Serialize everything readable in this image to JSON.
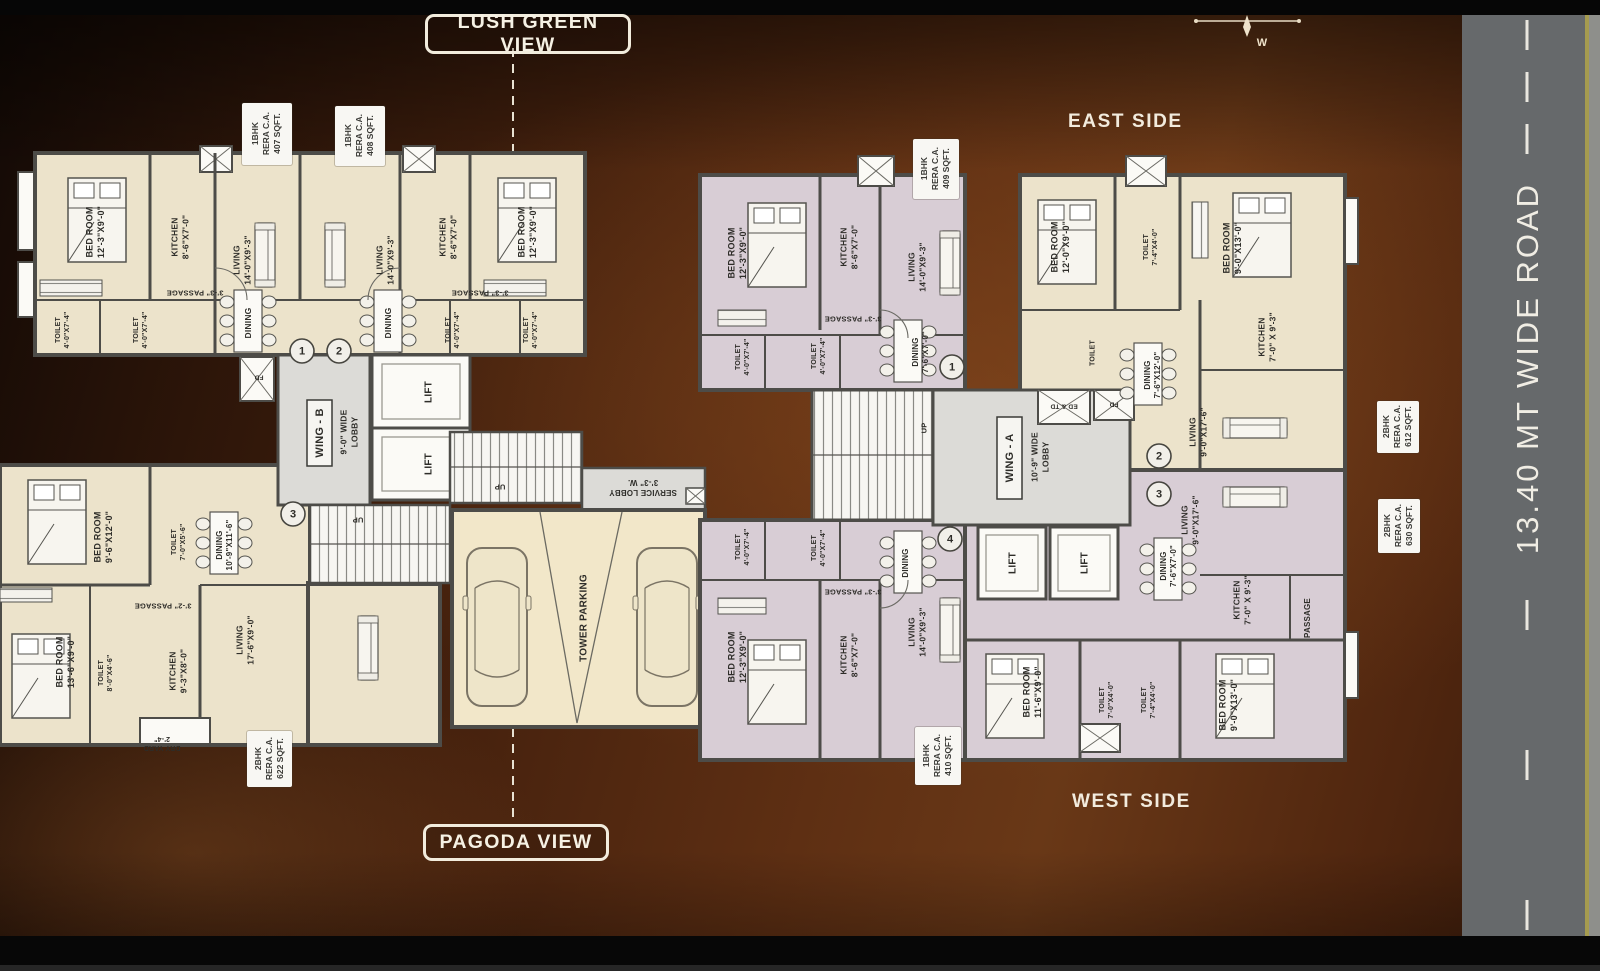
{
  "labels": {
    "lush_green_view": "LUSH GREEN VIEW",
    "pagoda_view": "PAGODA VIEW",
    "east_side": "EAST SIDE",
    "west_side": "WEST SIDE",
    "road": "13.40 MT WIDE ROAD",
    "compass_w": "W"
  },
  "colors": {
    "room_cream": "#ece3cb",
    "room_lavender": "#d8cdd5",
    "wall": "#4d4c48",
    "lobby_gray": "#dcdbd7",
    "road_gray": "#66696b",
    "road_edge_yellow": "#a59b4f",
    "background_brown": "#5e2f13"
  },
  "rera_labels": [
    {
      "unit": "1BHK",
      "cert": "RERA C.A.",
      "area": "407 SQFT.",
      "x": 242,
      "y": 103,
      "w": 50,
      "h": 62
    },
    {
      "unit": "1BHK",
      "cert": "RERA C.A.",
      "area": "408 SQFT.",
      "x": 335,
      "y": 106,
      "w": 50,
      "h": 60
    },
    {
      "unit": "1BHK",
      "cert": "RERA C.A.",
      "area": "409 SQFT.",
      "x": 913,
      "y": 139,
      "w": 46,
      "h": 60
    },
    {
      "unit": "1BHK",
      "cert": "RERA C.A.",
      "area": "410 SQFT.",
      "x": 915,
      "y": 727,
      "w": 46,
      "h": 58
    },
    {
      "unit": "2BHK",
      "cert": "RERA C.A.",
      "area": "612 SQFT.",
      "x": 1377,
      "y": 401,
      "w": 42,
      "h": 52
    },
    {
      "unit": "2BHK",
      "cert": "RERA C.A.",
      "area": "630 SQFT.",
      "x": 1378,
      "y": 499,
      "w": 42,
      "h": 54
    },
    {
      "unit": "2BHK",
      "cert": "RERA C.A.",
      "area": "622 SQFT.",
      "x": 247,
      "y": 731,
      "w": 45,
      "h": 56
    }
  ],
  "plan": {
    "wing_b_name": "WING - B",
    "wing_a_name": "WING - A",
    "entrance_numbers": [
      {
        "n": "1",
        "x": 302,
        "y": 351
      },
      {
        "n": "2",
        "x": 339,
        "y": 351
      },
      {
        "n": "3",
        "x": 293,
        "y": 514
      },
      {
        "n": "1",
        "x": 952,
        "y": 367
      },
      {
        "n": "2",
        "x": 1159,
        "y": 456
      },
      {
        "n": "3",
        "x": 1159,
        "y": 494
      },
      {
        "n": "4",
        "x": 950,
        "y": 539
      }
    ],
    "room_labels": [
      {
        "t": [
          "BED ROOM",
          "12'-3\"X9'-0\""
        ],
        "x": 95,
        "y": 232,
        "r": -90,
        "s": 9,
        "n": "room-label-bedroom"
      },
      {
        "t": [
          "KITCHEN",
          "8'-6\"X7'-0\""
        ],
        "x": 180,
        "y": 237,
        "r": -90,
        "s": 8.5,
        "n": "room-label-kitchen"
      },
      {
        "t": [
          "LIVING",
          "14'-0\"X9'-3\""
        ],
        "x": 242,
        "y": 260,
        "r": -90,
        "s": 8.5,
        "n": "room-label-living"
      },
      {
        "t": [
          "LIVING",
          "14'-0\"X9'-3\""
        ],
        "x": 385,
        "y": 260,
        "r": -90,
        "s": 8.5,
        "n": "room-label-living"
      },
      {
        "t": [
          "KITCHEN",
          "8'-6\"X7'-0\""
        ],
        "x": 448,
        "y": 237,
        "r": -90,
        "s": 8.5,
        "n": "room-label-kitchen"
      },
      {
        "t": [
          "BED ROOM",
          "12'-3\"X9'-0\""
        ],
        "x": 527,
        "y": 232,
        "r": -90,
        "s": 9,
        "n": "room-label-bedroom"
      },
      {
        "t": [
          "DINING"
        ],
        "x": 248,
        "y": 323,
        "r": -90,
        "s": 8.5,
        "n": "room-label-dining"
      },
      {
        "t": [
          "DINING"
        ],
        "x": 388,
        "y": 323,
        "r": -90,
        "s": 8.5,
        "n": "room-label-dining"
      },
      {
        "t": [
          "3'-3\" PASSAGE"
        ],
        "x": 195,
        "y": 293,
        "r": 180,
        "s": 7.5,
        "n": "room-label-passage"
      },
      {
        "t": [
          "3'-3\" PASSAGE"
        ],
        "x": 480,
        "y": 293,
        "r": 180,
        "s": 7.5,
        "n": "room-label-passage"
      },
      {
        "t": [
          "TOILET",
          "4'-0\"X7'-4\""
        ],
        "x": 62,
        "y": 330,
        "r": -90,
        "s": 7,
        "n": "room-label-toilet"
      },
      {
        "t": [
          "TOILET",
          "4'-0\"X7'-4\""
        ],
        "x": 140,
        "y": 330,
        "r": -90,
        "s": 7,
        "n": "room-label-toilet"
      },
      {
        "t": [
          "TOILET",
          "4'-0\"X7'-4\""
        ],
        "x": 452,
        "y": 330,
        "r": -90,
        "s": 7,
        "n": "room-label-toilet"
      },
      {
        "t": [
          "TOILET",
          "4'-0\"X7'-4\""
        ],
        "x": 530,
        "y": 330,
        "r": -90,
        "s": 7,
        "n": "room-label-toilet"
      },
      {
        "t": [
          "WING - B"
        ],
        "x": 319,
        "y": 433,
        "r": -90,
        "s": 11,
        "b": 1,
        "n": "wing-b-label"
      },
      {
        "t": [
          "9'-0\" WIDE",
          "LOBBY"
        ],
        "x": 349,
        "y": 432,
        "r": -90,
        "s": 8.5,
        "n": "lobby-label"
      },
      {
        "t": [
          "LIFT"
        ],
        "x": 428,
        "y": 392,
        "r": -90,
        "s": 10,
        "n": "lift-label"
      },
      {
        "t": [
          "LIFT"
        ],
        "x": 428,
        "y": 464,
        "r": -90,
        "s": 10,
        "n": "lift-label"
      },
      {
        "t": [
          "FD"
        ],
        "x": 259,
        "y": 378,
        "r": 180,
        "s": 6.5,
        "n": "duct-label"
      },
      {
        "t": [
          "UP"
        ],
        "x": 358,
        "y": 520,
        "r": 180,
        "s": 7.5,
        "n": "stairs-up-label"
      },
      {
        "t": [
          "UP"
        ],
        "x": 500,
        "y": 487,
        "r": 180,
        "s": 7.5,
        "n": "stairs-up-label"
      },
      {
        "t": [
          "SERVICE LOBBY",
          "3'-3\" W."
        ],
        "x": 643,
        "y": 488,
        "r": 180,
        "s": 8,
        "n": "service-lobby-label"
      },
      {
        "t": [
          "TOWER PARKING"
        ],
        "x": 583,
        "y": 618,
        "r": -90,
        "s": 10,
        "n": "parking-label"
      },
      {
        "t": [
          "BED ROOM",
          "9'-6\"X12'-0\""
        ],
        "x": 103,
        "y": 537,
        "r": -90,
        "s": 9,
        "n": "room-label-bedroom"
      },
      {
        "t": [
          "TOILET",
          "7'-0\"X5'-6\""
        ],
        "x": 178,
        "y": 542,
        "r": -90,
        "s": 7,
        "n": "room-label-toilet"
      },
      {
        "t": [
          "DINING",
          "10'-9\"X11'-6\""
        ],
        "x": 224,
        "y": 545,
        "r": -90,
        "s": 8,
        "n": "room-label-dining"
      },
      {
        "t": [
          "3'-2\" PASSAGE"
        ],
        "x": 163,
        "y": 606,
        "r": 180,
        "s": 7.5,
        "n": "room-label-passage"
      },
      {
        "t": [
          "BED ROOM",
          "13'-6\"X9'-0\""
        ],
        "x": 65,
        "y": 662,
        "r": -90,
        "s": 9,
        "n": "room-label-bedroom"
      },
      {
        "t": [
          "TOILET",
          "8'-0\"X4'-6\""
        ],
        "x": 105,
        "y": 673,
        "r": -90,
        "s": 7,
        "n": "room-label-toilet"
      },
      {
        "t": [
          "KITCHEN",
          "9'-3\"X8'-0\""
        ],
        "x": 178,
        "y": 671,
        "r": -90,
        "s": 8.5,
        "n": "room-label-kitchen"
      },
      {
        "t": [
          "LIVING",
          "17'-6\"X9'-0\""
        ],
        "x": 245,
        "y": 640,
        "r": -90,
        "s": 8.5,
        "n": "room-label-living"
      },
      {
        "t": [
          "DRY YARD",
          "2'-4\""
        ],
        "x": 162,
        "y": 744,
        "r": 180,
        "s": 7,
        "n": "room-label-dryyard"
      },
      {
        "t": [
          "BED ROOM",
          "12'-3\"X9'-0\""
        ],
        "x": 737,
        "y": 253,
        "r": -90,
        "s": 9,
        "n": "room-label-bedroom"
      },
      {
        "t": [
          "KITCHEN",
          "8'-6\"X7'-0\""
        ],
        "x": 849,
        "y": 247,
        "r": -90,
        "s": 8.5,
        "n": "room-label-kitchen"
      },
      {
        "t": [
          "LIVING",
          "14'-0\"X9'-3\""
        ],
        "x": 917,
        "y": 267,
        "r": -90,
        "s": 8.5,
        "n": "room-label-living"
      },
      {
        "t": [
          "3'-3\" PASSAGE"
        ],
        "x": 853,
        "y": 319,
        "r": 180,
        "s": 7.5,
        "n": "room-label-passage"
      },
      {
        "t": [
          "TOILET",
          "4'-0\"X7'-4\""
        ],
        "x": 742,
        "y": 357,
        "r": -90,
        "s": 7,
        "n": "room-label-toilet"
      },
      {
        "t": [
          "TOILET",
          "4'-0\"X7'-4\""
        ],
        "x": 818,
        "y": 356,
        "r": -90,
        "s": 7,
        "n": "room-label-toilet"
      },
      {
        "t": [
          "DINING",
          "7'-6\"X7'-0\""
        ],
        "x": 920,
        "y": 352,
        "r": -90,
        "s": 8,
        "n": "room-label-dining"
      },
      {
        "t": [
          "UP"
        ],
        "x": 924,
        "y": 428,
        "r": -90,
        "s": 7.5,
        "n": "stairs-up-label"
      },
      {
        "t": [
          "WING - A"
        ],
        "x": 1009,
        "y": 458,
        "r": -90,
        "s": 11,
        "b": 1,
        "n": "wing-a-label"
      },
      {
        "t": [
          "10'-9\" WIDE",
          "LOBBY"
        ],
        "x": 1040,
        "y": 457,
        "r": -90,
        "s": 8.5,
        "n": "lobby-label"
      },
      {
        "t": [
          "ED & TD"
        ],
        "x": 1064,
        "y": 407,
        "r": 180,
        "s": 6.5,
        "n": "duct-label"
      },
      {
        "t": [
          "FD"
        ],
        "x": 1114,
        "y": 405,
        "r": 180,
        "s": 6.5,
        "n": "duct-label"
      },
      {
        "t": [
          "LIFT"
        ],
        "x": 1012,
        "y": 563,
        "r": -90,
        "s": 10,
        "n": "lift-label"
      },
      {
        "t": [
          "LIFT"
        ],
        "x": 1084,
        "y": 563,
        "r": -90,
        "s": 10,
        "n": "lift-label"
      },
      {
        "t": [
          "BED ROOM",
          "12'-0\"X9'-0\""
        ],
        "x": 1060,
        "y": 247,
        "r": -90,
        "s": 9,
        "n": "room-label-bedroom"
      },
      {
        "t": [
          "TOILET",
          "7'-4\"X4'-0\""
        ],
        "x": 1150,
        "y": 247,
        "r": -90,
        "s": 7,
        "n": "room-label-toilet"
      },
      {
        "t": [
          "BED ROOM",
          "9'-0\"X13'-0\""
        ],
        "x": 1232,
        "y": 248,
        "r": -90,
        "s": 9,
        "n": "room-label-bedroom"
      },
      {
        "t": [
          "KITCHEN",
          "7'-0\" X 9'-3\""
        ],
        "x": 1267,
        "y": 337,
        "r": -90,
        "s": 8.5,
        "n": "room-label-kitchen"
      },
      {
        "t": [
          "DINING",
          "7'-6\"X12'-0\""
        ],
        "x": 1152,
        "y": 375,
        "r": -90,
        "s": 8,
        "n": "room-label-dining"
      },
      {
        "t": [
          "TOILET"
        ],
        "x": 1092,
        "y": 353,
        "r": -90,
        "s": 7,
        "n": "room-label-toilet"
      },
      {
        "t": [
          "LIVING",
          "9'-0\"X17'-6\""
        ],
        "x": 1198,
        "y": 432,
        "r": -90,
        "s": 8.5,
        "n": "room-label-living"
      },
      {
        "t": [
          "LIVING",
          "9'-0\"X17'-6\""
        ],
        "x": 1190,
        "y": 520,
        "r": -90,
        "s": 8.5,
        "n": "room-label-living"
      },
      {
        "t": [
          "DINING",
          "7'-6\"X7'-0\""
        ],
        "x": 1168,
        "y": 566,
        "r": -90,
        "s": 8,
        "n": "room-label-dining"
      },
      {
        "t": [
          "KITCHEN",
          "7'-0\" X 9'-3\""
        ],
        "x": 1242,
        "y": 600,
        "r": -90,
        "s": 8.5,
        "n": "room-label-kitchen"
      },
      {
        "t": [
          "PASSAGE"
        ],
        "x": 1307,
        "y": 618,
        "r": -90,
        "s": 8,
        "n": "room-label-passage"
      },
      {
        "t": [
          "BED ROOM",
          "11'-6\"X9'-0\""
        ],
        "x": 1032,
        "y": 692,
        "r": -90,
        "s": 9,
        "n": "room-label-bedroom"
      },
      {
        "t": [
          "TOILET",
          "7'-0\"X4'-0\""
        ],
        "x": 1106,
        "y": 700,
        "r": -90,
        "s": 7,
        "n": "room-label-toilet"
      },
      {
        "t": [
          "TOILET",
          "7'-4\"X4'-0\""
        ],
        "x": 1148,
        "y": 700,
        "r": -90,
        "s": 7,
        "n": "room-label-toilet"
      },
      {
        "t": [
          "BED ROOM",
          "9'-0\"X13'-0\""
        ],
        "x": 1228,
        "y": 705,
        "r": -90,
        "s": 9,
        "n": "room-label-bedroom"
      },
      {
        "t": [
          "TOILET",
          "4'-0\"X7'-4\""
        ],
        "x": 742,
        "y": 547,
        "r": -90,
        "s": 7,
        "n": "room-label-toilet"
      },
      {
        "t": [
          "TOILET",
          "4'-0\"X7'-4\""
        ],
        "x": 818,
        "y": 548,
        "r": -90,
        "s": 7,
        "n": "room-label-toilet"
      },
      {
        "t": [
          "3'-3\" PASSAGE"
        ],
        "x": 853,
        "y": 592,
        "r": 180,
        "s": 7.5,
        "n": "room-label-passage"
      },
      {
        "t": [
          "BED ROOM",
          "12'-3\"X9'-0\""
        ],
        "x": 737,
        "y": 657,
        "r": -90,
        "s": 9,
        "n": "room-label-bedroom"
      },
      {
        "t": [
          "KITCHEN",
          "8'-6\"X7'-0\""
        ],
        "x": 849,
        "y": 655,
        "r": -90,
        "s": 8.5,
        "n": "room-label-kitchen"
      },
      {
        "t": [
          "LIVING",
          "14'-0\"X9'-3\""
        ],
        "x": 917,
        "y": 632,
        "r": -90,
        "s": 8.5,
        "n": "room-label-living"
      },
      {
        "t": [
          "DINING"
        ],
        "x": 905,
        "y": 563,
        "r": -90,
        "s": 8,
        "n": "room-label-dining"
      }
    ]
  }
}
